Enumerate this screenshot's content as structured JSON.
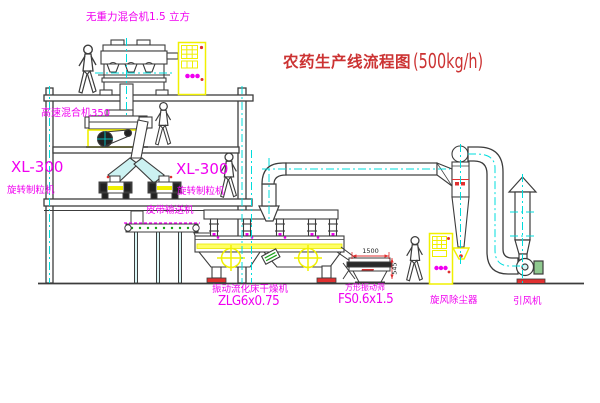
{
  "title": {
    "text": "农药生产线流程图",
    "capacity": "(500kg/h)"
  },
  "labels": {
    "gravity_mixer": "无重力混合机1.5 立方",
    "high_speed_mixer": "高速混合机350",
    "xl300_left": "XL-300",
    "granulator_left": "旋转制粒机",
    "xl300_mid": "XL-300",
    "granulator_mid": "旋转制粒机",
    "belt_conveyor": "皮带输送机",
    "dryer_name": "振动流化床干燥机",
    "dryer_model": "ZLG6x0.75",
    "sieve_name": "方形振动筛",
    "sieve_model": "FS0.6x1.5",
    "cyclone": "旋风除尘器",
    "fan": "引风机"
  },
  "dimensions": {
    "sieve_width": "1500",
    "sieve_height": "545"
  },
  "colors": {
    "label_magenta": "#f000f0",
    "title_red": "#cc3333",
    "machine_line": "#3c3c3c",
    "accent_yellow": "#f0f000",
    "centerline_cyan": "#00dcdc",
    "accent_red": "#e03030",
    "accent_green": "#18a018"
  }
}
